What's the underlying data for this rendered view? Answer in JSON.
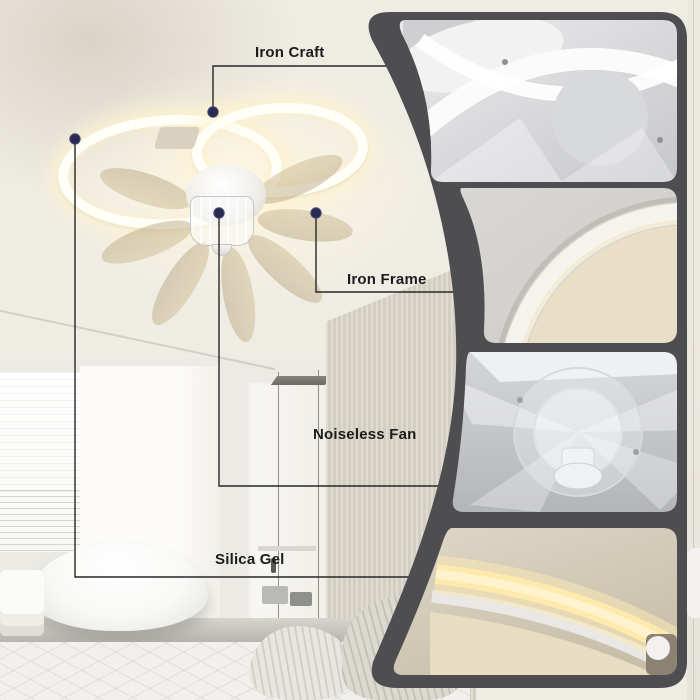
{
  "product_annotation": {
    "callouts": [
      {
        "id": "iron-craft",
        "label": "Iron Craft"
      },
      {
        "id": "iron-frame",
        "label": "Iron Frame"
      },
      {
        "id": "noiseless-fan",
        "label": "Noiseless Fan"
      },
      {
        "id": "silica-gel",
        "label": "Silica Gel"
      }
    ]
  },
  "detail_panel": {
    "thumbnails": [
      {
        "name": "fan-underside-detail"
      },
      {
        "name": "iron-frame-ring-detail"
      },
      {
        "name": "noiseless-fan-motor-detail"
      },
      {
        "name": "warm-led-ring-detail"
      }
    ]
  },
  "colors": {
    "callout_line": "#262626",
    "callout_dot": "#2b2b52",
    "panel_frame": "#4e4e50",
    "led_glow": "#ffeaae",
    "blade_tint": "#d3c5a3"
  }
}
